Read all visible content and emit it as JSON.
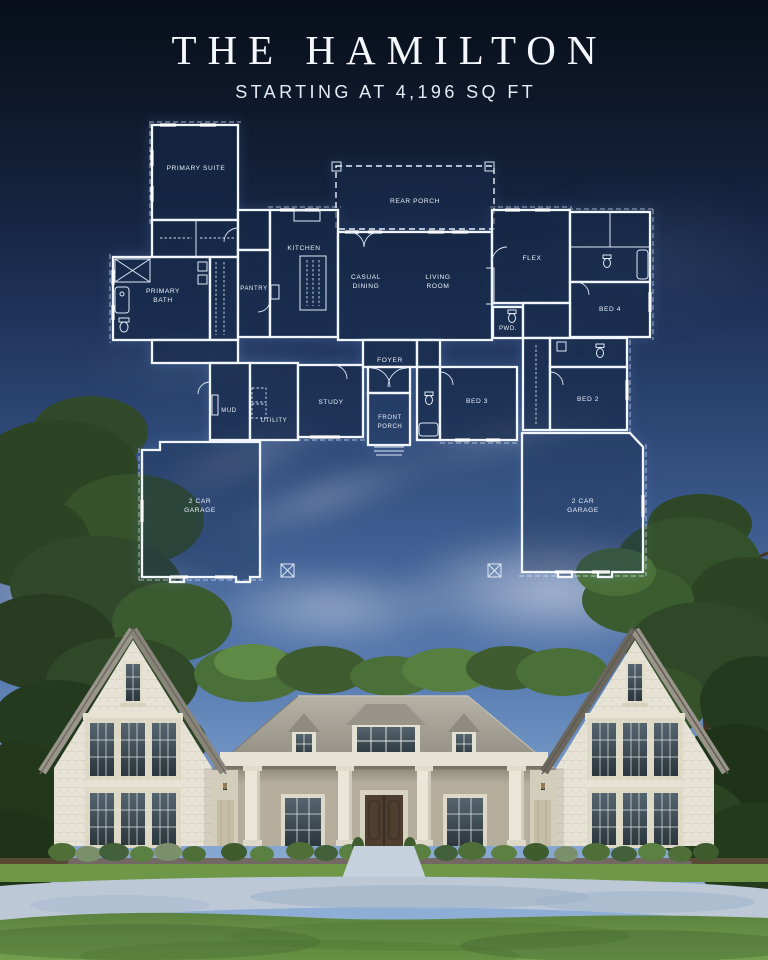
{
  "header": {
    "title": "THE HAMILTON",
    "subtitle": "STARTING AT 4,196 SQ FT"
  },
  "floor_plan": {
    "rooms": {
      "primary_suite": [
        "PRIMARY SUITE"
      ],
      "primary_bath": [
        "PRIMARY",
        "BATH"
      ],
      "pantry": [
        "PANTRY"
      ],
      "kitchen": [
        "KITCHEN"
      ],
      "rear_porch": [
        "REAR PORCH"
      ],
      "casual_dining": [
        "CASUAL",
        "DINING"
      ],
      "living_room": [
        "LIVING",
        "ROOM"
      ],
      "flex": [
        "FLEX"
      ],
      "bed4": [
        "BED 4"
      ],
      "pwd": [
        "PWD."
      ],
      "foyer": [
        "FOYER"
      ],
      "mud": [
        "MUD"
      ],
      "utility": [
        "UTILITY"
      ],
      "study": [
        "STUDY"
      ],
      "front_porch": [
        "FRONT",
        "PORCH"
      ],
      "bed3": [
        "BED 3"
      ],
      "bed2": [
        "BED 2"
      ],
      "garage_left": [
        "2 CAR",
        "GARAGE"
      ],
      "garage_right": [
        "2 CAR",
        "GARAGE"
      ]
    },
    "style": {
      "line_color": "#f1f6fd",
      "room_fill": "rgba(9,23,50,0.55)"
    }
  },
  "palette": {
    "sky_top": "#080e1b",
    "sky_bottom": "#94b3d9",
    "stone": "#e7e3d6",
    "roof": "#a09c91",
    "lawn": "#6a9448",
    "driveway": "#bcc8d6"
  }
}
